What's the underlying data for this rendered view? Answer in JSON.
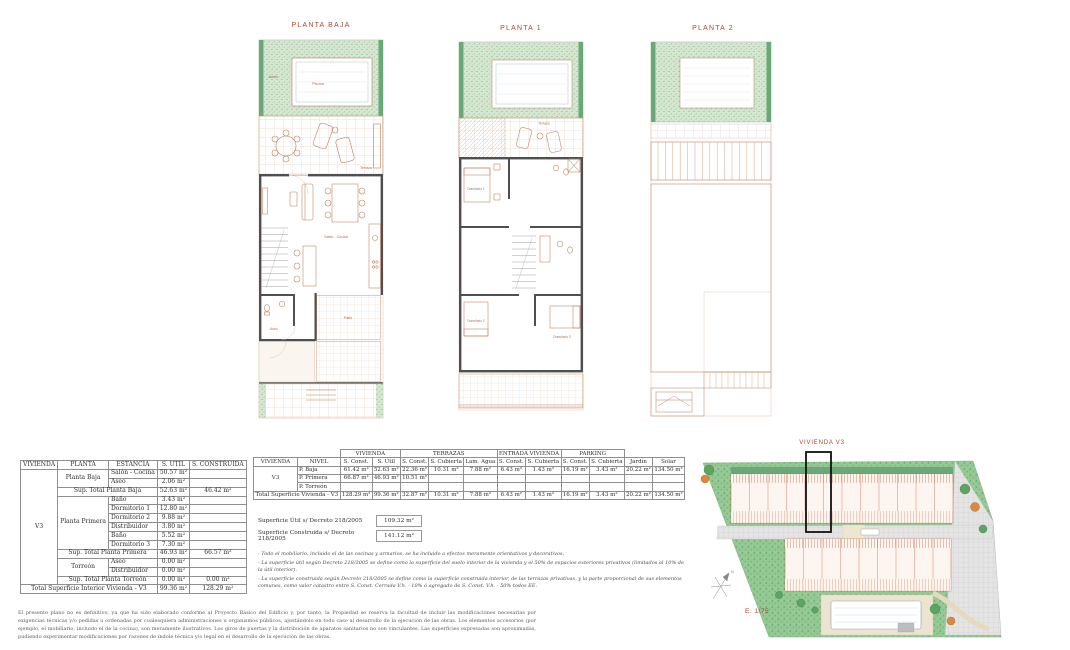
{
  "plans": {
    "p1": {
      "title": "PLANTA BAJA",
      "rooms": {
        "jardin": "Jardín",
        "piscina": "Piscina",
        "terraza": "Terraza",
        "salon": "Salón - Cocina",
        "aseo": "Aseo",
        "patio": "Patio"
      }
    },
    "p2": {
      "title": "PLANTA 1",
      "rooms": {
        "dorm1": "Dormitorio 1",
        "dorm2": "Dormitorio 2",
        "dorm3": "Dormitorio 3",
        "terraza": "Terraza"
      }
    },
    "p3": {
      "title": "PLANTA 2"
    }
  },
  "site": {
    "label": "VIVIENDA V3",
    "scale": "E: 1/75",
    "north": "N"
  },
  "t1": {
    "h": [
      "VIVIENDA",
      "PLANTA",
      "ESTANCIA",
      "S. UTIL",
      "S. CONSTRUIDA"
    ],
    "vivienda": "V3",
    "planta_baja": "Planta Baja",
    "planta_primera": "Planta Primera",
    "torreon": "Torreón",
    "r": [
      [
        "Salón - Cocina",
        "50.57 m²"
      ],
      [
        "Aseo",
        "2.06 m²"
      ],
      [
        "Sup. Total Planta Baja",
        "52.63 m²",
        "46.42 m²"
      ],
      [
        "Baño",
        "3.43 m²"
      ],
      [
        "Dormitorio 1",
        "12.80 m²"
      ],
      [
        "Dormitorio 2",
        "9.88 m²"
      ],
      [
        "Distribuidor",
        "3.80 m²"
      ],
      [
        "Baño",
        "5.52 m²"
      ],
      [
        "Dormitorio 3",
        "7.30 m²"
      ],
      [
        "Sup. Total Planta Primera",
        "46.93 m²",
        "66.57 m²"
      ],
      [
        "Aseo",
        "0.00 m²"
      ],
      [
        "Distribuidor",
        "0.00 m²"
      ],
      [
        "Sup. Total Planta Torreón",
        "0.00 m²",
        "0.00 m²"
      ],
      [
        "Total Superficie Interior Vivienda - V3",
        "99.36 m²",
        "128.29 m²"
      ]
    ]
  },
  "t2": {
    "groups": [
      "VIVIENDA",
      "TERRAZAS",
      "ENTRADA VIVIENDA",
      "PARKING"
    ],
    "h": [
      "VIVIENDA",
      "NIVEL",
      "S. Const.",
      "S. Útil",
      "S. Const.",
      "S. Cubierta",
      "Lam. Agua",
      "S. Const.",
      "S. Cubierta",
      "S. Const.",
      "S. Cubierta",
      "Jardín",
      "Solar"
    ],
    "vivienda": "V3",
    "r": [
      [
        "P. Baja",
        "61.42 m²",
        "52.63 m²",
        "22.36 m²",
        "10.31 m²",
        "7.88 m²",
        "6.43 m²",
        "1.43 m²",
        "16.19 m²",
        "3.43 m²",
        "20.22 m²",
        "134.50 m²"
      ],
      [
        "P. Primera",
        "66.87 m²",
        "46.93 m²",
        "10.51 m²",
        "",
        "",
        "",
        "",
        "",
        "",
        "",
        ""
      ],
      [
        "P. Torreón",
        "",
        "",
        "",
        "",
        "",
        "",
        "",
        "",
        "",
        "",
        ""
      ],
      [
        "Total Superficie Vivienda - V3",
        "128.29 m²",
        "99.36 m²",
        "32.87 m²",
        "10.31 m²",
        "7.88 m²",
        "6.43 m²",
        "1.43 m²",
        "16.19 m²",
        "3.43 m²",
        "20.22 m²",
        "134.50 m²"
      ]
    ]
  },
  "decreto": {
    "util_label": "Superficie Útil s/ Decreto 218/2005",
    "util_value": "109.32 m²",
    "construida_label": "Superficie Construida s/ Decreto 218/2005",
    "construida_value": "141.12 m²"
  },
  "notes": [
    "- Todo el mobiliario, incluido el de las cocinas y armarios, se ha incluido a efectos meramente orientativos y decorativos.",
    "- La superficie útil según Decreto 218/2005 se define como la superficie del suelo interior de la vivienda y el 50% de espacios exteriores privativos (limitados al 10% de la útil interior).",
    "- La superficie construida según Decreto 218/2005 se define como la superficie construida interior, de las terrazas privativas, y la parte proporcional de sus elementos comunes, como valor catastro entre S. Const. Cerrada V.h. - 10% ó agregado de S. Const. V.h. - 50% todos EE."
  ],
  "disclaimer": "El presente plano no es definitivo, ya que ha sido elaborado conforme al Proyecto Básico del Edificio y, por tanto, la Propiedad se reserva la facultad de incluir las modificaciones necesarias por exigencias técnicas y/o pedidas u ordenadas por cualesquiera administraciones u organismos públicos, ajustándolo en todo caso al desarrollo de la ejecución de las obras. Los elementos accesorios (por ejemplo, el mobiliario, incluido el de la cocina), son meramente ilustrativos. Los giros de puertas y la distribución de aparatos sanitarios no son vinculantes. Las superficies expresadas son aproximadas, pudiendo experimentar modificaciones por razones de índole técnica y/o legal en el desarrollo de la ejecución de las obras.",
  "colors": {
    "label_red": "#a64a33",
    "plan_line": "#bd7e5e",
    "wall": "#4f4f4f",
    "garden": "#93c893",
    "hedge": "#6aa878"
  }
}
